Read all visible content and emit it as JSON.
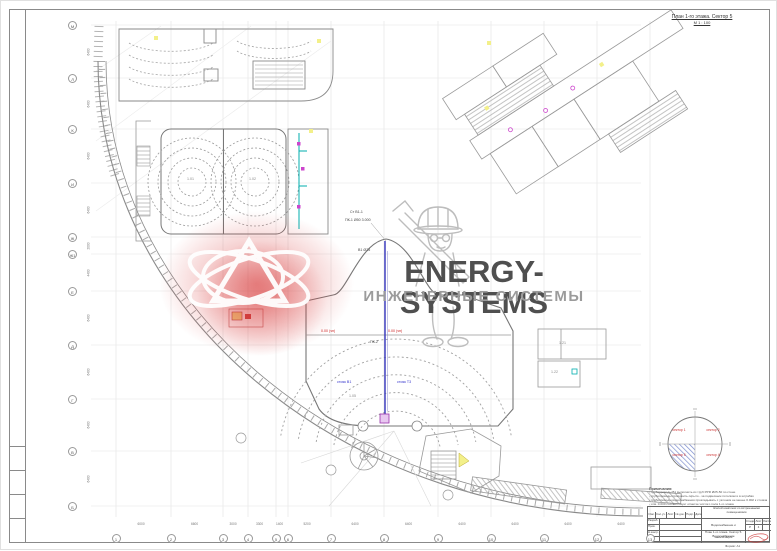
{
  "header": {
    "title": "План 1-го этажа. Сектор 5",
    "scale": "М 1 : 100"
  },
  "watermark": {
    "brand": "ENERGY-SYSTEMS",
    "subtitle": "ИНЖЕНЕРНЫЕ СИСТЕМЫ",
    "brand_color": "#4f4f4f",
    "subtitle_color": "#9b9b9b",
    "logo_glow_color": "#d63434"
  },
  "axes": {
    "bottom": [
      {
        "label": "1",
        "x": 115
      },
      {
        "label": "2",
        "x": 170
      },
      {
        "label": "3",
        "x": 222
      },
      {
        "label": "4",
        "x": 247
      },
      {
        "label": "5",
        "x": 275
      },
      {
        "label": "6",
        "x": 287
      },
      {
        "label": "7",
        "x": 330
      },
      {
        "label": "8",
        "x": 383
      },
      {
        "label": "9",
        "x": 437
      },
      {
        "label": "10",
        "x": 490
      },
      {
        "label": "11",
        "x": 543
      },
      {
        "label": "12",
        "x": 596
      },
      {
        "label": "13",
        "x": 649
      }
    ],
    "bottom_dims": [
      "6000",
      "6600",
      "3000",
      "3300",
      "1400",
      "5200",
      "6400",
      "6400",
      "6400",
      "6400",
      "6400",
      "6400"
    ],
    "left": [
      {
        "label": "М",
        "y": 24
      },
      {
        "label": "Л",
        "y": 77
      },
      {
        "label": "К",
        "y": 128
      },
      {
        "label": "И",
        "y": 182
      },
      {
        "label": "Ж",
        "y": 236
      },
      {
        "label": "Ж1",
        "y": 253
      },
      {
        "label": "Е",
        "y": 290
      },
      {
        "label": "Д",
        "y": 344
      },
      {
        "label": "Г",
        "y": 398
      },
      {
        "label": "В",
        "y": 450
      },
      {
        "label": "Б",
        "y": 505
      }
    ],
    "left_dims": [
      "6400",
      "6400",
      "6400",
      "6400",
      "2000",
      "4400",
      "6400",
      "6400",
      "6400",
      "6400"
    ]
  },
  "labels": [
    {
      "t": "Ст В1-1",
      "x": 349,
      "y": 209,
      "c": "#444"
    },
    {
      "t": "ПК-1 Ø50 3.000",
      "x": 344,
      "y": 217,
      "c": "#444"
    },
    {
      "t": "В1 Ø25",
      "x": 357,
      "y": 247,
      "c": "#444"
    },
    {
      "t": "0.00 (чп)",
      "x": 320,
      "y": 328,
      "c": "#cc2222"
    },
    {
      "t": "0.00 (чп)",
      "x": 387,
      "y": 328,
      "c": "#cc2222"
    },
    {
      "t": "ПК-2",
      "x": 369,
      "y": 339,
      "c": "#444"
    },
    {
      "t": "стояк В1",
      "x": 336,
      "y": 379,
      "c": "#3333cc"
    },
    {
      "t": "стояк Т3",
      "x": 396,
      "y": 379,
      "c": "#3333cc"
    },
    {
      "t": "1.01",
      "x": 186,
      "y": 176,
      "c": "#888"
    },
    {
      "t": "1.02",
      "x": 248,
      "y": 176,
      "c": "#888"
    },
    {
      "t": "1.05",
      "x": 348,
      "y": 393,
      "c": "#888"
    },
    {
      "t": "1.21",
      "x": 558,
      "y": 340,
      "c": "#888"
    },
    {
      "t": "1.22",
      "x": 550,
      "y": 369,
      "c": "#888"
    }
  ],
  "sector_diagram": {
    "q1": "сектор 1",
    "q2": "сектор 2",
    "q3": "сектор 5",
    "q4": "сектор 4"
  },
  "notes": {
    "title": "Примечания:",
    "items": [
      "- трубопроводы В1 выполнить из труб PPR Ø25-50 по стене",
      "- трубопроводы проложить скрыто - за подвесным потолком и в штрабах",
      "- трубопроводы водоснабжения прокладывать с уклоном не менее 0.002 к стоякам В1-1...В1-9",
      "- отм. 0.000 соответствует отметке чистого пола 1-го этажа"
    ]
  },
  "title_block": {
    "project_line1": "Жилой комплекс со встроенными",
    "project_line2": "помещениями",
    "doc_type": "Водоснабжение и канализация",
    "sheet_title_line1": "План 1-го этажа. Сектор 5.",
    "sheet_title_line2": "Водоснабжение",
    "stage_h": "Стадия",
    "list_h": "Лист",
    "lists_h": "Листов",
    "stage_v": "Р",
    "list_v": "4",
    "lists_v": "",
    "cols": [
      "Изм.",
      "Кол.уч.",
      "Лист",
      "№ док.",
      "Подп.",
      "Дата"
    ],
    "rows": [
      "Разраб.",
      "Пров.",
      "Н.контр.",
      "Утв."
    ],
    "format": "Формат А1"
  }
}
